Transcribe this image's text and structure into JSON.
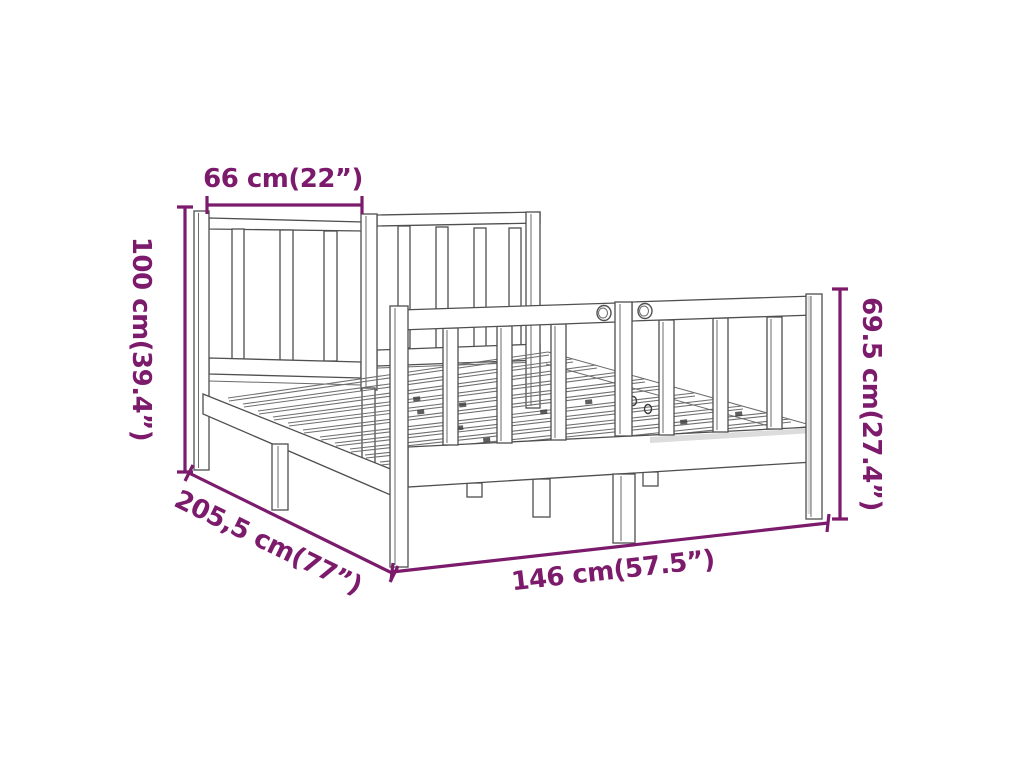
{
  "diagram": {
    "subject": "bed-frame-dimension-diagram",
    "background": "#ffffff",
    "accent_color": "#7c1a6c",
    "outline_color": "#4f4f4f",
    "dimensions": [
      {
        "id": "headboard-panel-width",
        "label": "66 cm(22”)",
        "orientation": "horizontal"
      },
      {
        "id": "headboard-height",
        "label": "100 cm(39.4”)",
        "orientation": "vertical"
      },
      {
        "id": "footboard-height",
        "label": "69.5 cm(27.4”)",
        "orientation": "vertical"
      },
      {
        "id": "frame-length",
        "label": "205,5 cm(77”)",
        "orientation": "diagonal"
      },
      {
        "id": "frame-width",
        "label": "146 cm(57.5”)",
        "orientation": "diagonal"
      }
    ]
  }
}
